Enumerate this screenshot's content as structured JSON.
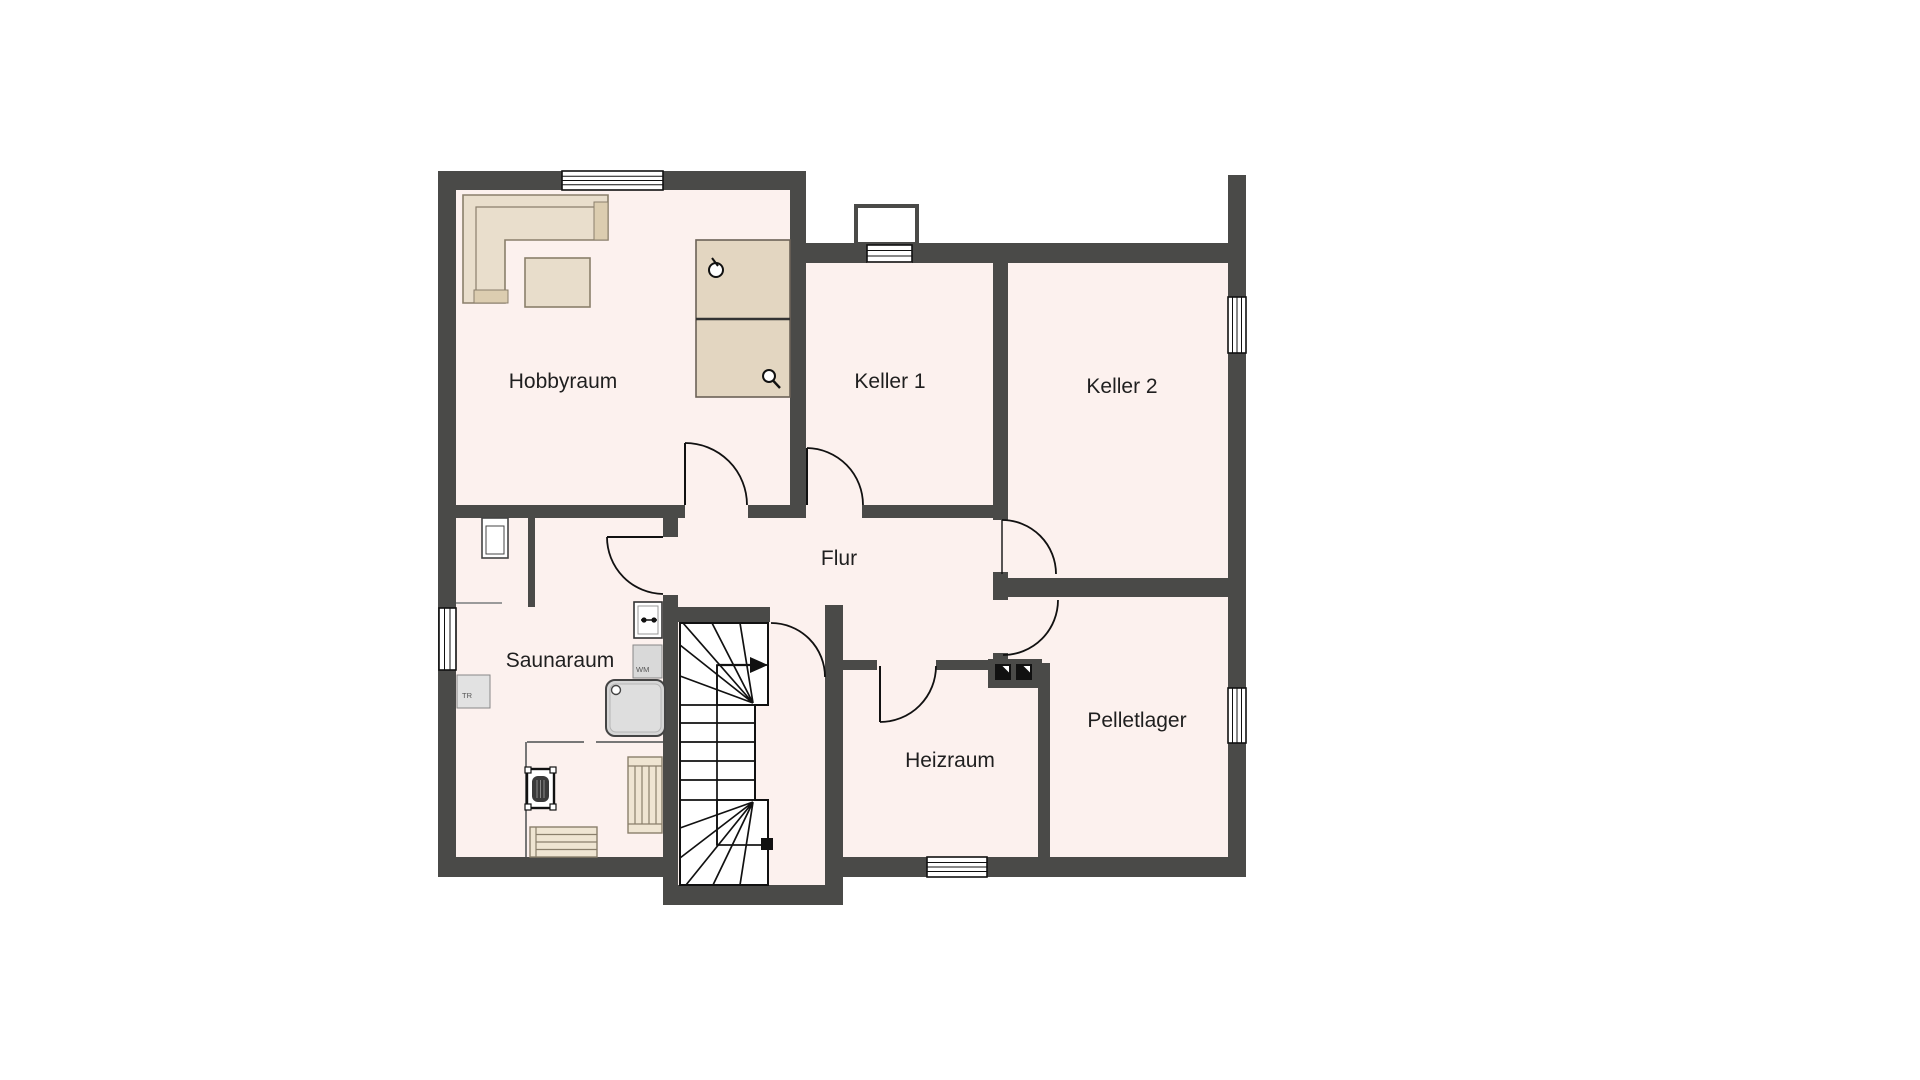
{
  "plan": {
    "title": "Kellergeschoss Grundriss",
    "colors": {
      "floor": "#fcf1ee",
      "wall": "#4a4a48",
      "furniture_tan": "#e9decc",
      "furniture_tan_dark": "#dccdb0",
      "appliance_grey": "#d9d9d9"
    },
    "rooms": [
      {
        "id": "hobbyraum",
        "label": "Hobbyraum"
      },
      {
        "id": "keller1",
        "label": "Keller 1"
      },
      {
        "id": "keller2",
        "label": "Keller 2"
      },
      {
        "id": "flur",
        "label": "Flur"
      },
      {
        "id": "saunaraum",
        "label": "Saunaraum"
      },
      {
        "id": "heizraum",
        "label": "Heizraum"
      },
      {
        "id": "pelletlager",
        "label": "Pelletlager"
      }
    ],
    "appliances": [
      {
        "id": "wm",
        "label": "WM"
      },
      {
        "id": "tr",
        "label": "TR"
      }
    ]
  }
}
